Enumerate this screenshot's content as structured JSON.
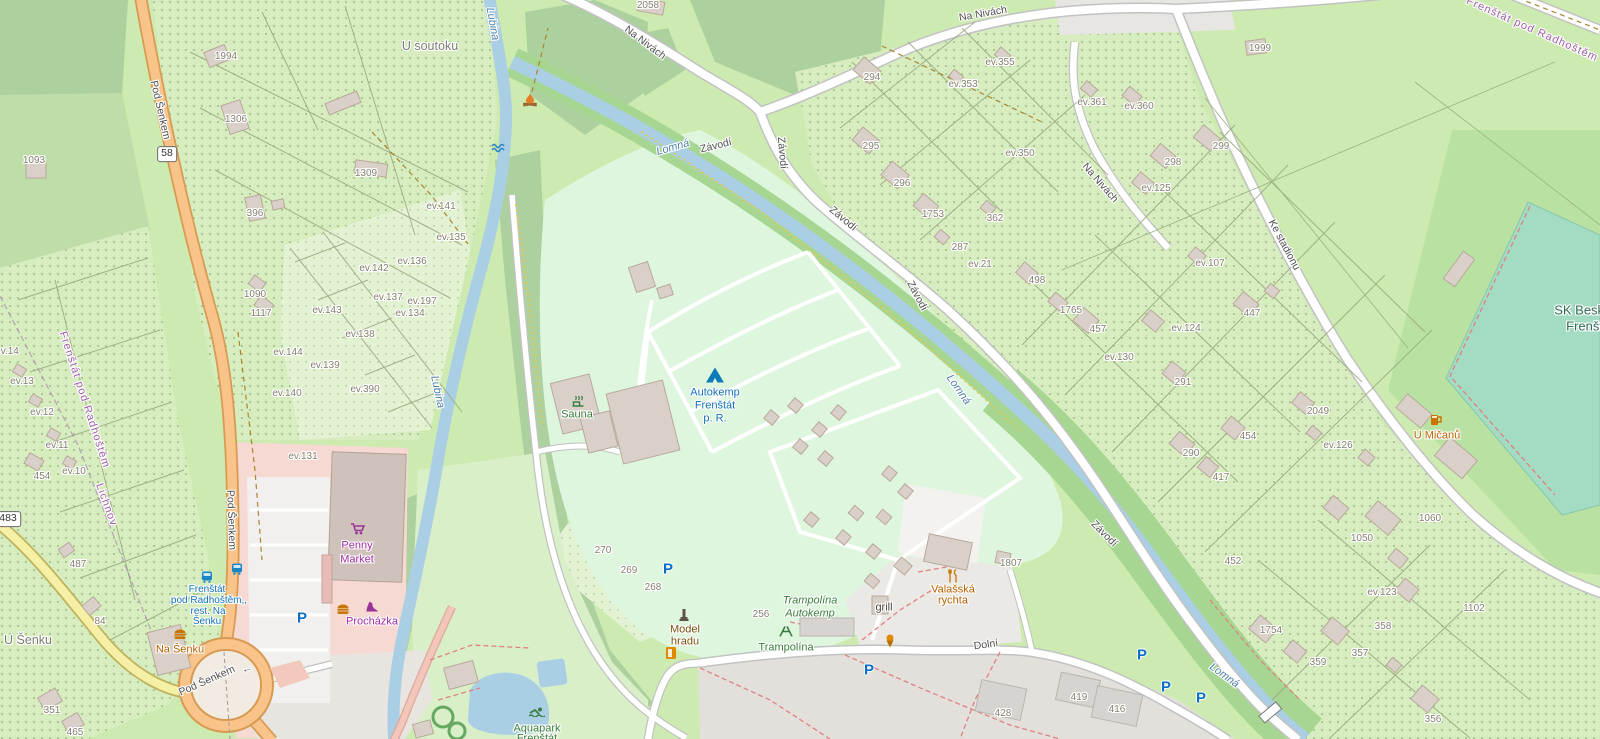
{
  "map": {
    "colors": {
      "grass": "#cdebb0",
      "forest": "#add19e",
      "allotment": "#d7edbf",
      "allotment_light": "#e4f2d4",
      "campsite": "#def6de",
      "pitch": "#a3dcc3",
      "retail": "#f6d9d2",
      "water": "#aacfe4",
      "road_primary": "#f9c489",
      "road_secondary": "#f6f0a6",
      "road_white": "#ffffff",
      "building": "#d9d0c9",
      "residential": "#e3e0dc",
      "poi_blue": "#1272b8",
      "poi_green": "#387d3c",
      "poi_amber": "#b96100",
      "poi_purple": "#a12ba5",
      "boundary_purple": "#a05fa8",
      "parking_blue": "#0a6ec6"
    },
    "labels": {
      "roads": [
        {
          "text": "Pod Šenkem",
          "x": 160,
          "y": 110,
          "r": 77
        },
        {
          "text": "Pod Šenkem",
          "x": 231,
          "y": 520,
          "r": 88
        },
        {
          "text": "Pod Šenkem",
          "x": 207,
          "y": 681,
          "r": -24
        },
        {
          "text": "←",
          "x": 247,
          "y": 669,
          "r": -15
        },
        {
          "text": "Na Nivách",
          "x": 645,
          "y": 43,
          "r": 37
        },
        {
          "text": "Na Nivách",
          "x": 983,
          "y": 14,
          "r": -10
        },
        {
          "text": "Na Nivách",
          "x": 1100,
          "y": 183,
          "r": 49
        },
        {
          "text": "Ke stadionu",
          "x": 1284,
          "y": 245,
          "r": 62
        },
        {
          "text": "Závodí",
          "x": 716,
          "y": 146,
          "r": -14
        },
        {
          "text": "Závodí",
          "x": 782,
          "y": 153,
          "r": 85
        },
        {
          "text": "Závodí",
          "x": 843,
          "y": 219,
          "r": 40
        },
        {
          "text": "Závodí",
          "x": 917,
          "y": 296,
          "r": 62
        },
        {
          "text": "Závodí",
          "x": 1104,
          "y": 534,
          "r": 45
        },
        {
          "text": "Dolní",
          "x": 986,
          "y": 645,
          "r": -8
        }
      ],
      "water": [
        {
          "text": "Lubina",
          "x": 492,
          "y": 24,
          "r": 80
        },
        {
          "text": "Lubina",
          "x": 437,
          "y": 392,
          "r": 78
        },
        {
          "text": "Lomná",
          "x": 673,
          "y": 148,
          "r": -16
        },
        {
          "text": "Lomná",
          "x": 958,
          "y": 390,
          "r": 55
        },
        {
          "text": "Lomná",
          "x": 1224,
          "y": 676,
          "r": 36
        }
      ],
      "places": [
        {
          "text": "U soutoku",
          "x": 430,
          "y": 46
        },
        {
          "text": "U Šenku",
          "x": 28,
          "y": 640
        }
      ],
      "boundaries": [
        {
          "text": "Frenštát pod Radhoštěm",
          "x": 84,
          "y": 400,
          "r": 72
        },
        {
          "text": "Lichnov",
          "x": 106,
          "y": 505,
          "r": 70
        },
        {
          "text": "Frenštát pod Radhoštěm",
          "x": 1532,
          "y": 30,
          "r": 24
        }
      ],
      "transit": [
        {
          "text": "Frenštát",
          "x": 207,
          "y": 590
        },
        {
          "text": "pod Radhoštěm,,",
          "x": 209,
          "y": 601
        },
        {
          "text": "rest. Na",
          "x": 208,
          "y": 612
        },
        {
          "text": "Šenku",
          "x": 207,
          "y": 622
        }
      ],
      "pois": {
        "blue": [
          {
            "text": "Autokemp",
            "x": 715,
            "y": 393
          },
          {
            "text": "Frenštát",
            "x": 715,
            "y": 406
          },
          {
            "text": "p. R.",
            "x": 715,
            "y": 419
          }
        ],
        "green": [
          {
            "text": "Sauna",
            "x": 577,
            "y": 415
          },
          {
            "text": "Trampolína",
            "x": 786,
            "y": 648
          },
          {
            "text": "Aquapark",
            "x": 537,
            "y": 729
          },
          {
            "text": "Frenštát",
            "x": 537,
            "y": 739
          }
        ],
        "green_italic": [
          {
            "text": "Trampolína",
            "x": 810,
            "y": 601
          },
          {
            "text": "Autokemp",
            "x": 810,
            "y": 614
          }
        ],
        "pitch": [
          {
            "text": "SK Beskyd",
            "x": 1586,
            "y": 310
          },
          {
            "text": "Frenštát",
            "x": 1590,
            "y": 326
          }
        ],
        "amber": [
          {
            "text": "Na Šenku",
            "x": 180,
            "y": 650
          },
          {
            "text": "Valašská",
            "x": 953,
            "y": 590
          },
          {
            "text": "rychta",
            "x": 953,
            "y": 601
          },
          {
            "text": "U Mičanů",
            "x": 1437,
            "y": 436
          }
        ],
        "purple": [
          {
            "text": "Penny",
            "x": 357,
            "y": 546
          },
          {
            "text": "Market",
            "x": 357,
            "y": 560
          },
          {
            "text": "Procházka",
            "x": 372,
            "y": 622
          }
        ],
        "dark": [
          {
            "text": "grill",
            "x": 884,
            "y": 608
          }
        ],
        "brown": [
          {
            "text": "Model",
            "x": 685,
            "y": 630
          },
          {
            "text": "hradu",
            "x": 685,
            "y": 642
          }
        ]
      },
      "shields": [
        {
          "text": "58",
          "x": 167,
          "y": 154
        },
        {
          "text": "483",
          "x": 8,
          "y": 519
        }
      ],
      "parcels": [
        {
          "text": "2058",
          "x": 648,
          "y": 6
        },
        {
          "text": "1994",
          "x": 226,
          "y": 57
        },
        {
          "text": "1306",
          "x": 236,
          "y": 120
        },
        {
          "text": "1093",
          "x": 34,
          "y": 161
        },
        {
          "text": "396",
          "x": 255,
          "y": 214
        },
        {
          "text": "1309",
          "x": 366,
          "y": 174
        },
        {
          "text": "ev.141",
          "x": 441,
          "y": 207
        },
        {
          "text": "ev.135",
          "x": 451,
          "y": 238
        },
        {
          "text": "ev.136",
          "x": 412,
          "y": 262
        },
        {
          "text": "ev.142",
          "x": 374,
          "y": 269
        },
        {
          "text": "ev.137",
          "x": 388,
          "y": 298
        },
        {
          "text": "ev.197",
          "x": 422,
          "y": 302
        },
        {
          "text": "ev.134",
          "x": 410,
          "y": 314
        },
        {
          "text": "ev.143",
          "x": 327,
          "y": 311
        },
        {
          "text": "ev.138",
          "x": 360,
          "y": 335
        },
        {
          "text": "ev.144",
          "x": 288,
          "y": 353
        },
        {
          "text": "ev.139",
          "x": 325,
          "y": 366
        },
        {
          "text": "ev.390",
          "x": 365,
          "y": 390
        },
        {
          "text": "ev.140",
          "x": 287,
          "y": 394
        },
        {
          "text": "ev.131",
          "x": 303,
          "y": 457
        },
        {
          "text": "1090",
          "x": 255,
          "y": 295
        },
        {
          "text": "1117",
          "x": 261,
          "y": 314
        },
        {
          "text": "ev.14",
          "x": 7,
          "y": 352
        },
        {
          "text": "ev.13",
          "x": 22,
          "y": 382
        },
        {
          "text": "ev.12",
          "x": 42,
          "y": 413
        },
        {
          "text": "ev.11",
          "x": 57,
          "y": 446
        },
        {
          "text": "ev.10",
          "x": 74,
          "y": 472
        },
        {
          "text": "454",
          "x": 42,
          "y": 477
        },
        {
          "text": "487",
          "x": 78,
          "y": 565
        },
        {
          "text": "84",
          "x": 100,
          "y": 622
        },
        {
          "text": "351",
          "x": 52,
          "y": 711
        },
        {
          "text": "465",
          "x": 75,
          "y": 733
        },
        {
          "text": "294",
          "x": 872,
          "y": 78
        },
        {
          "text": "ev.355",
          "x": 1000,
          "y": 63
        },
        {
          "text": "ev.353",
          "x": 963,
          "y": 85
        },
        {
          "text": "295",
          "x": 871,
          "y": 147
        },
        {
          "text": "296",
          "x": 902,
          "y": 184
        },
        {
          "text": "1753",
          "x": 933,
          "y": 215
        },
        {
          "text": "362",
          "x": 995,
          "y": 219
        },
        {
          "text": "287",
          "x": 960,
          "y": 248
        },
        {
          "text": "ev.350",
          "x": 1020,
          "y": 154
        },
        {
          "text": "ev.21",
          "x": 980,
          "y": 265
        },
        {
          "text": "ev.361",
          "x": 1092,
          "y": 103
        },
        {
          "text": "ev.360",
          "x": 1139,
          "y": 107
        },
        {
          "text": "1999",
          "x": 1260,
          "y": 49
        },
        {
          "text": "299",
          "x": 1221,
          "y": 147
        },
        {
          "text": "298",
          "x": 1173,
          "y": 163
        },
        {
          "text": "ev.125",
          "x": 1156,
          "y": 189
        },
        {
          "text": "ev.107",
          "x": 1210,
          "y": 264
        },
        {
          "text": "447",
          "x": 1252,
          "y": 314
        },
        {
          "text": "498",
          "x": 1037,
          "y": 281
        },
        {
          "text": "1765",
          "x": 1071,
          "y": 311
        },
        {
          "text": "457",
          "x": 1098,
          "y": 330
        },
        {
          "text": "ev.130",
          "x": 1119,
          "y": 358
        },
        {
          "text": "ev.124",
          "x": 1186,
          "y": 329
        },
        {
          "text": "291",
          "x": 1183,
          "y": 383
        },
        {
          "text": "290",
          "x": 1191,
          "y": 454
        },
        {
          "text": "417",
          "x": 1221,
          "y": 478
        },
        {
          "text": "454",
          "x": 1248,
          "y": 437
        },
        {
          "text": "2049",
          "x": 1318,
          "y": 412
        },
        {
          "text": "ev.126",
          "x": 1338,
          "y": 446
        },
        {
          "text": "452",
          "x": 1233,
          "y": 562
        },
        {
          "text": "1807",
          "x": 1011,
          "y": 564
        },
        {
          "text": "1050",
          "x": 1362,
          "y": 539
        },
        {
          "text": "1060",
          "x": 1430,
          "y": 519
        },
        {
          "text": "ev.123",
          "x": 1382,
          "y": 593
        },
        {
          "text": "1102",
          "x": 1474,
          "y": 609
        },
        {
          "text": "358",
          "x": 1383,
          "y": 627
        },
        {
          "text": "357",
          "x": 1360,
          "y": 654
        },
        {
          "text": "359",
          "x": 1318,
          "y": 663
        },
        {
          "text": "1754",
          "x": 1271,
          "y": 631
        },
        {
          "text": "356",
          "x": 1433,
          "y": 720
        },
        {
          "text": "428",
          "x": 1003,
          "y": 714
        },
        {
          "text": "419",
          "x": 1079,
          "y": 698
        },
        {
          "text": "416",
          "x": 1117,
          "y": 710
        },
        {
          "text": "270",
          "x": 603,
          "y": 551
        },
        {
          "text": "269",
          "x": 629,
          "y": 571
        },
        {
          "text": "268",
          "x": 653,
          "y": 588
        },
        {
          "text": "256",
          "x": 761,
          "y": 615
        }
      ]
    },
    "icons": [
      {
        "name": "tent-icon",
        "x": 715,
        "y": 375
      },
      {
        "name": "campfire-icon",
        "x": 530,
        "y": 100
      },
      {
        "name": "waves-icon",
        "x": 498,
        "y": 148
      },
      {
        "name": "sauna-icon",
        "x": 578,
        "y": 401
      },
      {
        "name": "swimmer-icon",
        "x": 537,
        "y": 712
      },
      {
        "name": "playground-icon",
        "x": 786,
        "y": 631
      },
      {
        "name": "monument-icon",
        "x": 684,
        "y": 615
      },
      {
        "name": "vending-icon",
        "x": 671,
        "y": 653
      },
      {
        "name": "icecream-icon",
        "x": 890,
        "y": 641
      },
      {
        "name": "restaurant-icon",
        "x": 953,
        "y": 576
      },
      {
        "name": "beer-icon",
        "x": 1436,
        "y": 420
      },
      {
        "name": "fastfood-icon",
        "x": 180,
        "y": 634
      },
      {
        "name": "fastfood-icon",
        "x": 343,
        "y": 609
      },
      {
        "name": "cart-icon",
        "x": 358,
        "y": 529
      },
      {
        "name": "shoe-icon",
        "x": 371,
        "y": 607
      },
      {
        "name": "bus-icon",
        "x": 207,
        "y": 577
      },
      {
        "name": "bus-icon",
        "x": 237,
        "y": 569
      },
      {
        "name": "parking-icon",
        "x": 302,
        "y": 618
      },
      {
        "name": "parking-icon",
        "x": 668,
        "y": 569
      },
      {
        "name": "parking-icon",
        "x": 869,
        "y": 670
      },
      {
        "name": "parking-icon",
        "x": 1142,
        "y": 655
      },
      {
        "name": "parking-icon",
        "x": 1166,
        "y": 687
      },
      {
        "name": "parking-icon",
        "x": 1201,
        "y": 698
      }
    ]
  }
}
